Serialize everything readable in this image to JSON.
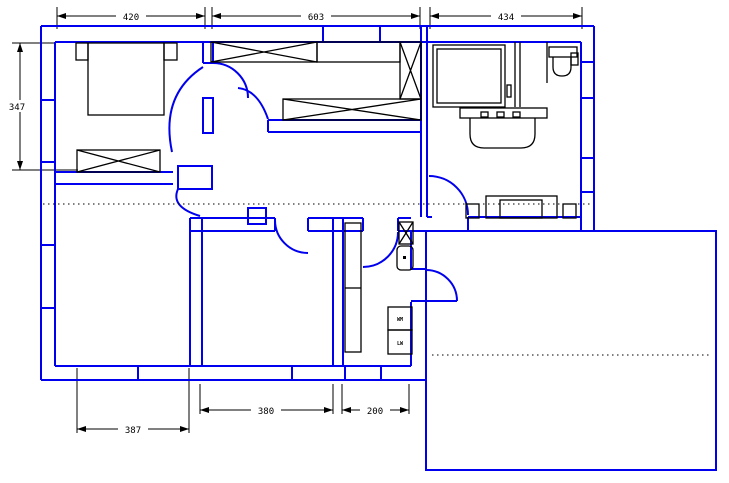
{
  "plan": {
    "colors": {
      "walls": "#0000EE",
      "annotations": "#000000",
      "background": "#FFFFFF"
    },
    "dimensions": {
      "top": [
        {
          "label": "420"
        },
        {
          "label": "603"
        },
        {
          "label": "434"
        }
      ],
      "left": [
        {
          "label": "347"
        }
      ],
      "bottom": [
        {
          "label": "387"
        },
        {
          "label": "380"
        },
        {
          "label": "200"
        }
      ]
    },
    "appliances": [
      {
        "label": "WM"
      },
      {
        "label": "LW"
      }
    ]
  }
}
